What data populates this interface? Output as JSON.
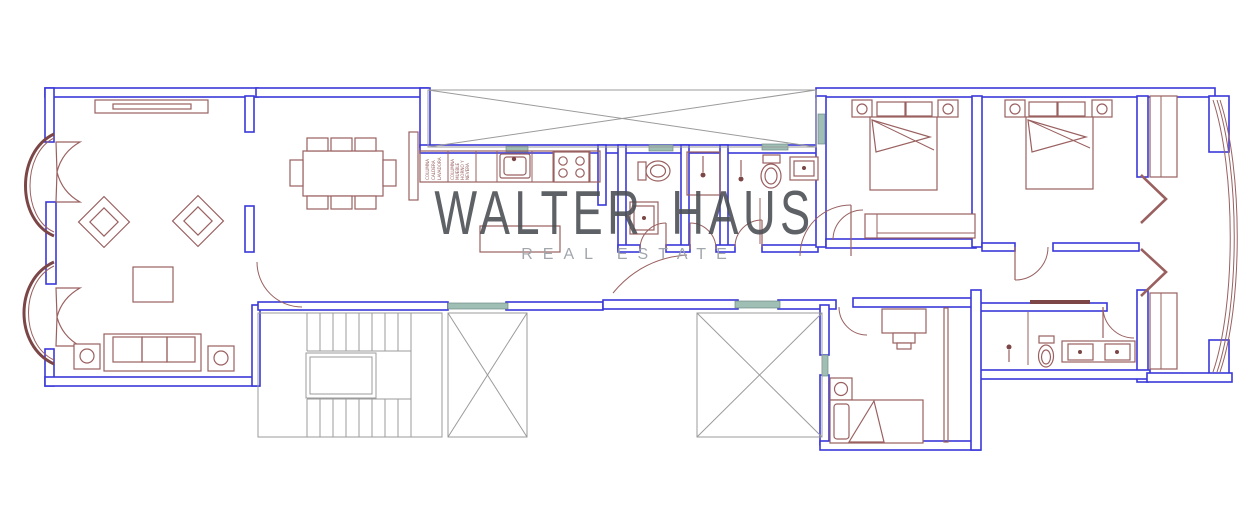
{
  "watermark": {
    "title": "WALTER HAUS",
    "subtitle": "REAL ESTATE"
  },
  "colors": {
    "wall": "#3a38d8",
    "furn": "#9a6060",
    "furndark": "#7c4646",
    "common": "#9b9b9b",
    "glass": "#9fbfb5",
    "wmtitle": "#4d5055",
    "wmsub": "#9ca2a9",
    "bg": "#ffffff"
  },
  "kitchen": {
    "column1_lines": [
      "COLUMNA",
      "CALDERA",
      "LAVADORA"
    ],
    "column2_lines": [
      "COLUMNA",
      "MUEBLE",
      "HORNO Y",
      "NEVERA"
    ]
  }
}
